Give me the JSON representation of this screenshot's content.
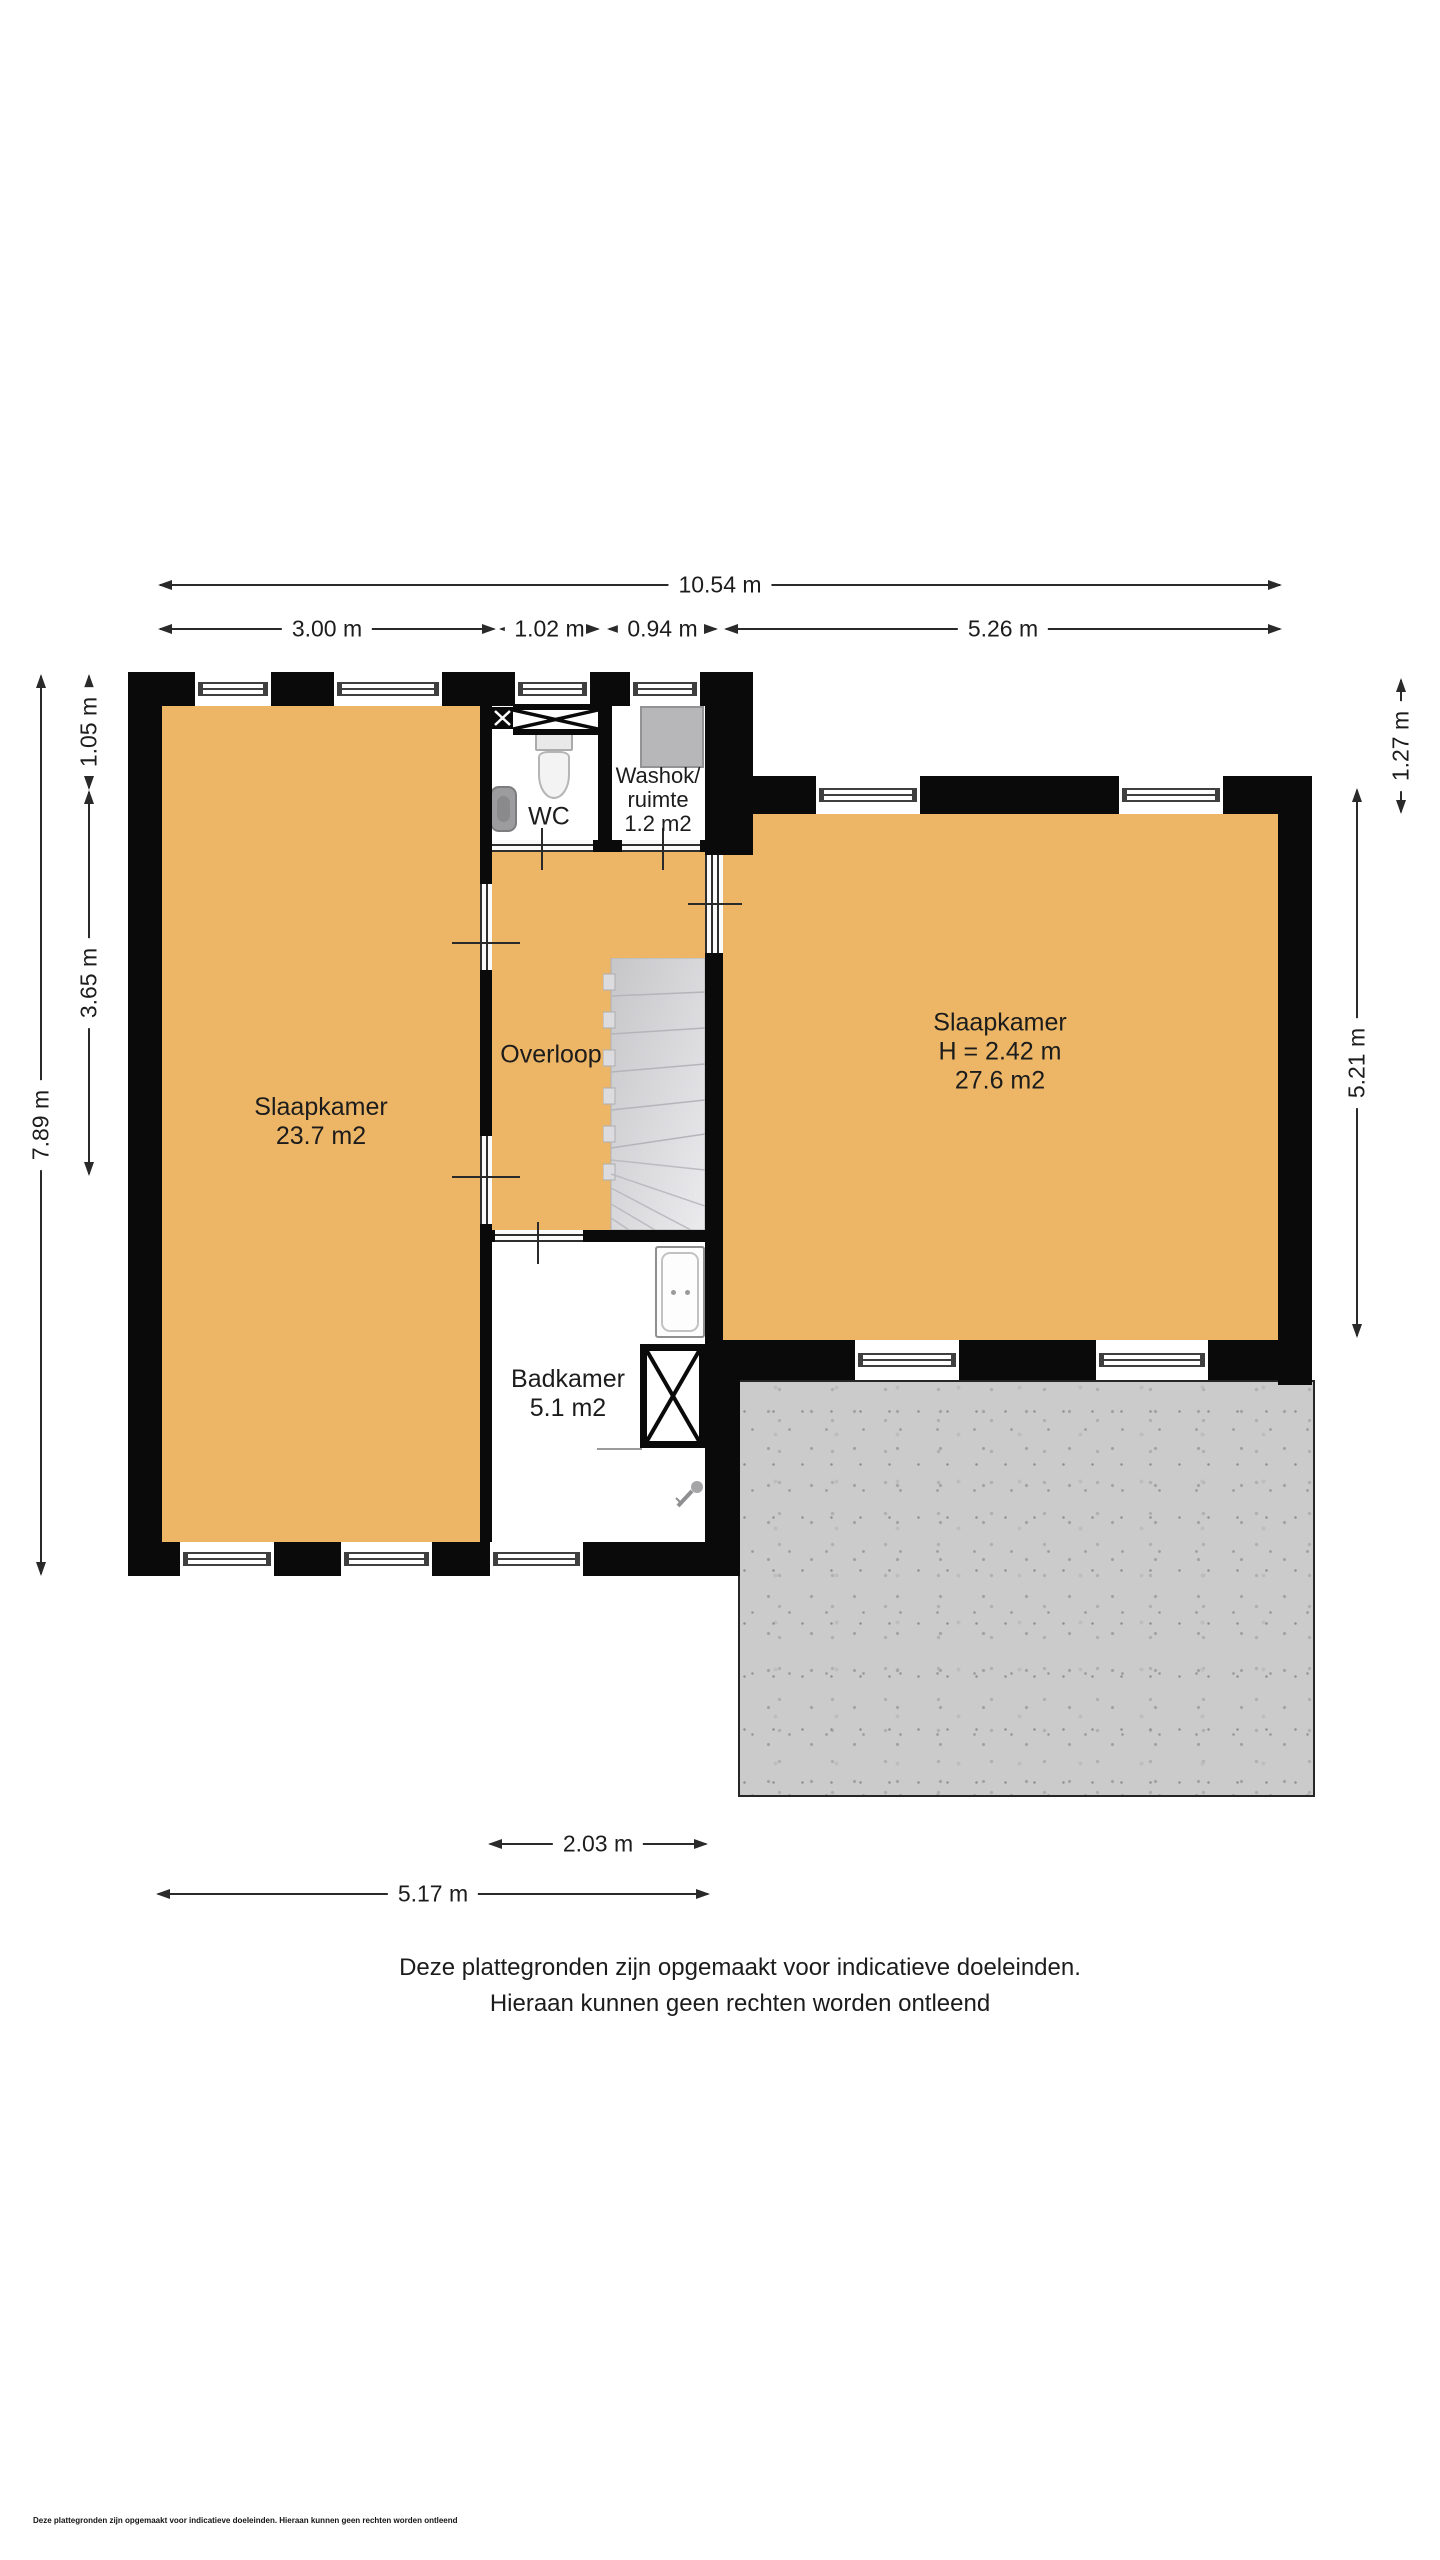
{
  "colors": {
    "floor_fill": "#ecb666",
    "wall": "#0a0a0a",
    "terrace": "#cbcbcb",
    "stairs": "#d4d4d7",
    "dimension_text": "#1c1c1c"
  },
  "dimensions": {
    "top": [
      {
        "name": "total-width",
        "label": "10.54 m"
      },
      {
        "name": "left-room-width",
        "label": "3.00 m"
      },
      {
        "name": "wc-width",
        "label": "1.02 m"
      },
      {
        "name": "washok-width",
        "label": "0.94 m"
      },
      {
        "name": "right-room-width",
        "label": "5.26 m"
      }
    ],
    "left": [
      {
        "name": "total-height",
        "label": "7.89 m"
      },
      {
        "name": "wc-depth",
        "label": "1.05 m"
      },
      {
        "name": "overloop-depth",
        "label": "3.65 m"
      }
    ],
    "right": [
      {
        "name": "right-offset-height",
        "label": "1.27 m"
      },
      {
        "name": "right-room-height",
        "label": "5.21 m"
      }
    ],
    "bottom": [
      {
        "name": "badkamer-width",
        "label": "2.03 m"
      },
      {
        "name": "bottom-width",
        "label": "5.17 m"
      }
    ]
  },
  "rooms": {
    "slaapkamer_left": {
      "name": "Slaapkamer",
      "area": "23.7 m2"
    },
    "wc": {
      "name": "WC"
    },
    "washok": {
      "line1": "Washok/",
      "line2": "ruimte",
      "area": "1.2 m2"
    },
    "overloop": {
      "name": "Overloop"
    },
    "slaapkamer_right": {
      "name": "Slaapkamer",
      "ceiling_height": "H = 2.42 m",
      "area": "27.6 m2"
    },
    "badkamer": {
      "name": "Badkamer",
      "area": "5.1 m2"
    }
  },
  "disclaimer": {
    "line1": "Deze plattegronden zijn opgemaakt voor indicatieve doeleinden.",
    "line2": "Hieraan kunnen geen rechten worden ontleend",
    "footnote": "Deze plattegronden zijn opgemaakt voor indicatieve doeleinden. Hieraan kunnen geen rechten worden ontleend"
  }
}
